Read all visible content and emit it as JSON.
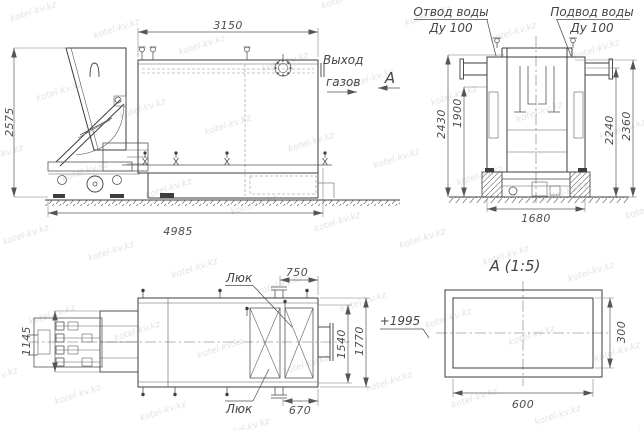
{
  "watermark": {
    "text": "kotel-kv.kz"
  },
  "front_view": {
    "dim_width_top": "3150",
    "dim_height_left": "2575",
    "dim_length_bottom": "4985",
    "gas_label_1": "Выход",
    "gas_label_2": "газов",
    "section_arrow_label": "А"
  },
  "side_view": {
    "water_outlet_1": "Отвод воды",
    "water_outlet_2": "Ду 100",
    "water_supply_1": "Подвод воды",
    "water_supply_2": "Ду 100",
    "dim_2430": "2430",
    "dim_1900": "1900",
    "dim_2240": "2240",
    "dim_2360": "2360",
    "dim_1680": "1680"
  },
  "plan_view": {
    "hatch_label_top": "Люк",
    "hatch_label_bottom": "Люк",
    "dim_750": "750",
    "dim_670": "670",
    "dim_1540": "1540",
    "dim_1770": "1770",
    "dim_1145": "1145",
    "elevation": "+1995"
  },
  "section_view": {
    "title": "А (1:5)",
    "dim_width": "600",
    "dim_height": "300"
  }
}
